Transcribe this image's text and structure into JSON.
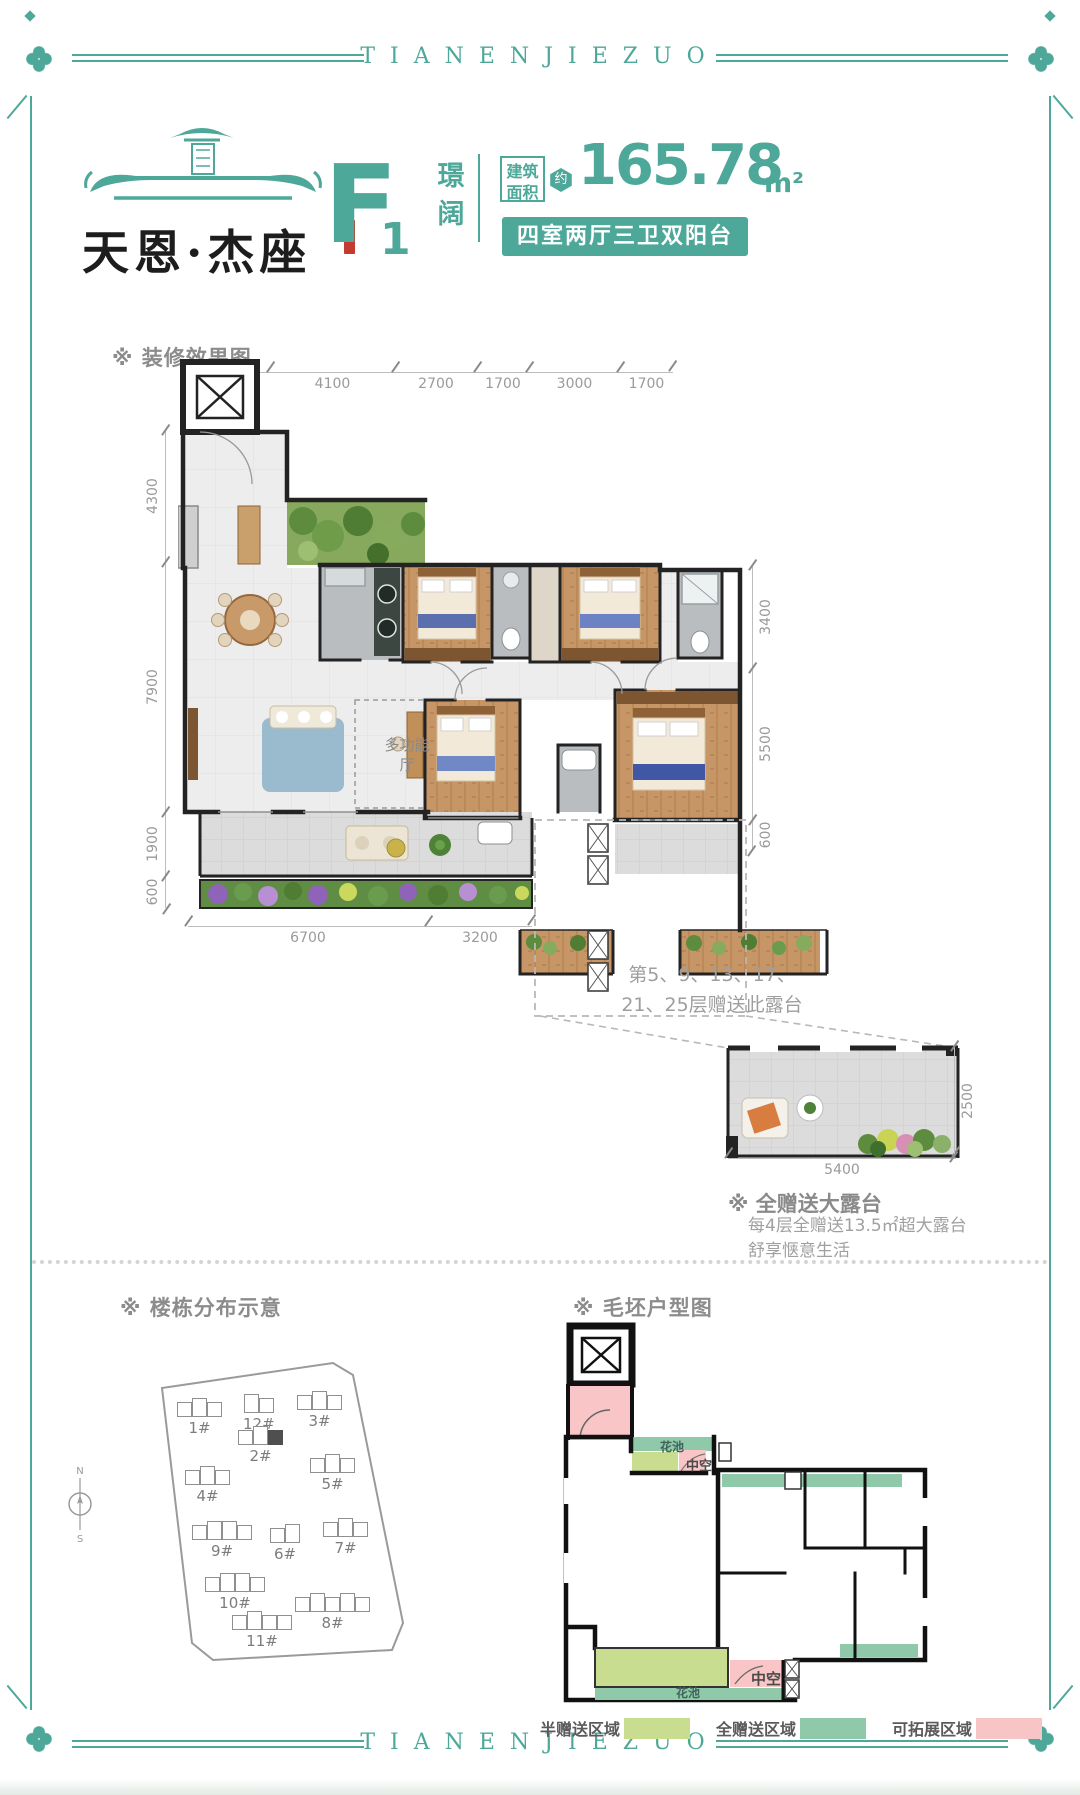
{
  "frame": {
    "top_text": "TIANENJIEZUO",
    "bottom_text": "TIANENJIEZUO"
  },
  "brand": {
    "name": "天恩·杰座"
  },
  "unit": {
    "model": "F",
    "model_index": "1",
    "alias": "璟阔",
    "area_label_line1": "建筑",
    "area_label_line2": "面积",
    "area_prefix": "约",
    "area_value": "165.78",
    "area_unit": "m²",
    "layout_badge": "四室两厅三卫双阳台"
  },
  "decorated": {
    "section_title": "※ 装修效果图",
    "dims_top": [
      "2400",
      "4100",
      "2700",
      "1700",
      "3000",
      "1700"
    ],
    "dims_left": [
      "4300",
      "7900",
      "1900",
      "600"
    ],
    "dims_right": [
      "3400",
      "5500",
      "600"
    ],
    "dims_bottom": [
      "6700",
      "3200"
    ],
    "room_label": "多功能厅",
    "note_line1": "第5、9、13、17、",
    "note_line2": "21、25层赠送此露台"
  },
  "terrace": {
    "title": "※ 全赠送大露台",
    "desc_line1": "每4层全赠送13.5㎡超大露台",
    "desc_line2": "舒享惬意生活",
    "dim_width": "5400",
    "dim_depth": "2500"
  },
  "site": {
    "section_title": "※ 楼栋分布示意",
    "buildings": [
      {
        "label": "1#",
        "highlighted": false
      },
      {
        "label": "12#",
        "highlighted": false
      },
      {
        "label": "3#",
        "highlighted": false
      },
      {
        "label": "2#",
        "highlighted": true
      },
      {
        "label": "4#",
        "highlighted": false
      },
      {
        "label": "5#",
        "highlighted": false
      },
      {
        "label": "9#",
        "highlighted": false
      },
      {
        "label": "6#",
        "highlighted": false
      },
      {
        "label": "7#",
        "highlighted": false
      },
      {
        "label": "10#",
        "highlighted": false
      },
      {
        "label": "11#",
        "highlighted": false
      },
      {
        "label": "8#",
        "highlighted": false
      }
    ]
  },
  "bare": {
    "section_title": "※ 毛坯户型图",
    "label_flower_top": "花池",
    "label_void_top": "中空",
    "label_flower_bottom": "花池",
    "label_void_bottom": "中空"
  },
  "legend": {
    "items": [
      {
        "label": "半赠送区域",
        "color": "#c9dd90"
      },
      {
        "label": "全赠送区域",
        "color": "#8fc9a9"
      },
      {
        "label": "可拓展区域",
        "color": "#f8c5c7"
      }
    ]
  },
  "compass": {
    "north": "N",
    "south": "S"
  },
  "colors": {
    "brand": "#4da89a",
    "wall": "#232323",
    "wood": "#c79667",
    "tile": "#ededed",
    "marble": "#b9bdbf",
    "dim_text": "#9a9a9a",
    "gray_text": "#8c8c8c"
  }
}
